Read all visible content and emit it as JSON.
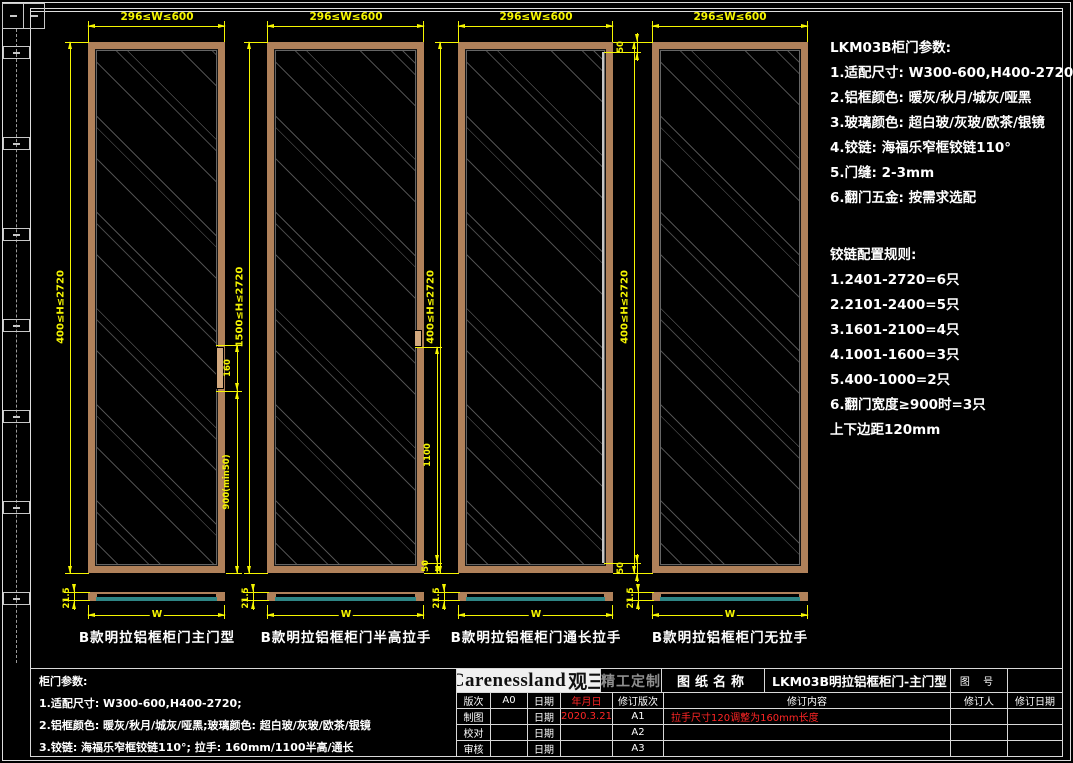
{
  "colors": {
    "dimension_yellow": "#f5f500",
    "frame_tan": "#b0815a",
    "glass_section_teal": "#2e8585",
    "revision_red": "#ff2525",
    "line_white": "#d8d8d8"
  },
  "doors": [
    {
      "label": "B款明拉铝框柜门主门型",
      "width_dim": "296≤W≤600",
      "height_dim": "400≤H≤2720",
      "handle_length_dim": "160",
      "handle_bottom_dim": "900(min50)",
      "thickness_dim": "21.5",
      "section_width_label": "W"
    },
    {
      "label": "B款明拉铝框柜门半高拉手",
      "width_dim": "296≤W≤600",
      "height_dim": "1500≤H≤2720",
      "handle_height_dim": "1100",
      "bottom_margin_dim": "50",
      "thickness_dim": "21.5",
      "section_width_label": "W"
    },
    {
      "label": "B款明拉铝框柜门通长拉手",
      "width_dim": "296≤W≤600",
      "height_dim": "400≤H≤2720",
      "top_margin_dim": "50",
      "bottom_margin_dim": "50",
      "thickness_dim": "21.5",
      "section_width_label": "W"
    },
    {
      "label": "B款明拉铝框柜门无拉手",
      "width_dim": "296≤W≤600",
      "height_dim": "400≤H≤2720",
      "thickness_dim": "21.5",
      "section_width_label": "W"
    }
  ],
  "params_block": {
    "title": "LKM03B柜门参数:",
    "lines": [
      "1.适配尺寸: W300-600,H400-2720",
      "2.铝框颜色: 暖灰/秋月/城灰/哑黑",
      "3.玻璃颜色: 超白玻/灰玻/欧茶/银镜",
      "4.铰链: 海福乐窄框铰链110°",
      "5.门缝: 2-3mm",
      "6.翻门五金: 按需求选配"
    ]
  },
  "hinge_block": {
    "title": "铰链配置规则:",
    "lines": [
      "1.2401-2720=6只",
      "2.2101-2400=5只",
      "3.1601-2100=4只",
      "4.1001-1600=3只",
      "5.400-1000=2只",
      "6.翻门宽度≥900时=3只",
      "上下边距120mm"
    ]
  },
  "notes_block": {
    "title": "柜门参数:",
    "lines": [
      "1.适配尺寸: W300-600,H400-2720;",
      "2.铝框颜色: 暖灰/秋月/城灰/哑黑;玻璃颜色: 超白玻/灰玻/欧茶/银镜",
      "3.铰链: 海福乐窄框铰链110°; 拉手: 160mm/1100半高/通长"
    ]
  },
  "titleblock": {
    "brand": "Carenessland",
    "brand_cn": "观三",
    "brand_sub": "精工定制",
    "drawing_name_label": "图纸名称",
    "drawing_name": "LKM03B明拉铝框柜门-主门型",
    "drawing_no_label": "图 号",
    "rows": {
      "r1": {
        "label": "版次",
        "value": "A0",
        "date_label": "日期",
        "date": "年月日",
        "rev_label": "修订版次",
        "content_label": "修订内容",
        "person_label": "修订人",
        "rev_date_label": "修订日期"
      },
      "r2": {
        "label": "制图",
        "date_label": "日期",
        "date": "2020.3.21",
        "rev": "A1",
        "content": "拉手尺寸120调整为160mm长度"
      },
      "r3": {
        "label": "校对",
        "date_label": "日期",
        "rev": "A2"
      },
      "r4": {
        "label": "审核",
        "date_label": "日期",
        "rev": "A3"
      }
    }
  }
}
